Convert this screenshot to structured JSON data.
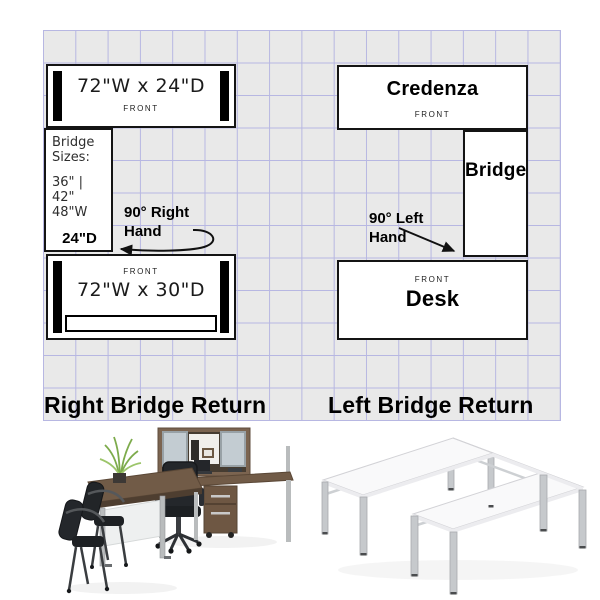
{
  "right_layout": {
    "title": "Right Bridge Return",
    "credenza": {
      "dimensions": "72\"W x 24\"D",
      "front_label": "FRONT"
    },
    "bridge_info": {
      "heading": "Bridge Sizes:",
      "sizes_line1": "36\" | 42\"",
      "sizes_line2": "48\"W",
      "depth": "24\"D"
    },
    "desk": {
      "dimensions": "72\"W x 30\"D",
      "front_label": "FRONT"
    },
    "annotation": {
      "line1": "90° Right",
      "line2": "Hand"
    }
  },
  "left_layout": {
    "title": "Left Bridge Return",
    "credenza": {
      "name": "Credenza",
      "front_label": "FRONT"
    },
    "bridge": {
      "name": "Bridge"
    },
    "desk": {
      "name": "Desk",
      "front_label": "FRONT"
    },
    "annotation": {
      "line1": "90° Left",
      "line2": "Hand"
    }
  },
  "photos": {
    "left_alt": "L-shaped desk set with hutch, mobile pedestal and guest chairs",
    "right_alt": "U-shaped white benching desk frame"
  },
  "colors": {
    "grid_background": "#e9e9e9",
    "grid_line": "#b7b7e2",
    "box_border": "#141414",
    "end_panel": "#000000",
    "walnut": "#6f5a47",
    "silver": "#b9bcbd",
    "chair_black": "#212428",
    "plant_green": "#7dab4c",
    "frame_white": "#f9f9fa"
  }
}
